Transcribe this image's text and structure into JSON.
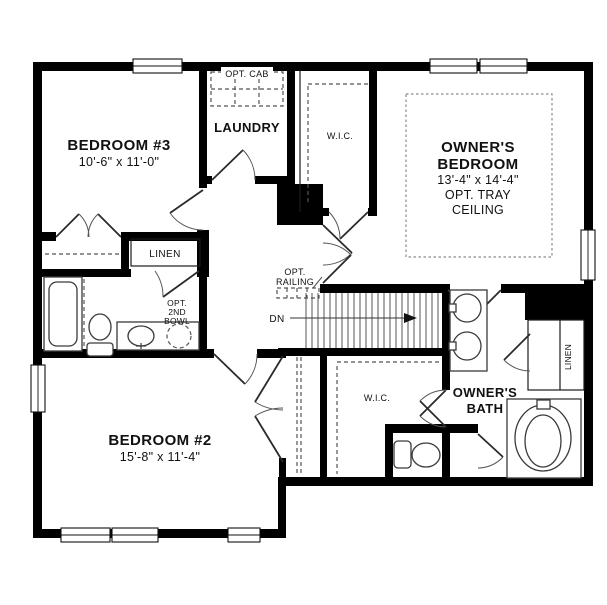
{
  "figure_type": "second-floor residential floor plan",
  "rooms": {
    "bedroom3": {
      "name": "BEDROOM #3",
      "dims": "10'-6\" x 11'-0\""
    },
    "bedroom2": {
      "name": "BEDROOM #2",
      "dims": "15'-8\" x 11'-4\""
    },
    "owners_bedroom": {
      "name_line1": "OWNER'S",
      "name_line2": "BEDROOM",
      "dims": "13'-4\" x 14'-4\"",
      "option_line1": "OPT. TRAY",
      "option_line2": "CEILING"
    },
    "laundry": {
      "name": "LAUNDRY"
    },
    "walk_in_closet_top": {
      "name": "W.I.C."
    },
    "walk_in_closet_bottom": {
      "name": "W.I.C."
    },
    "owners_bath": {
      "name_line1": "OWNER'S",
      "name_line2": "BATH"
    },
    "linen_hall": {
      "name": "LINEN"
    },
    "linen_owners": {
      "name": "LINEN"
    }
  },
  "annotations": {
    "optional_cabinets": "OPT. CAB",
    "optional_railing_line1": "OPT.",
    "optional_railing_line2": "RAILING",
    "stair_direction": "DN",
    "optional_second_bowl_line1": "OPT.",
    "optional_second_bowl_line2": "2ND",
    "optional_second_bowl_line3": "BOWL"
  },
  "colors": {
    "wall": "#000000",
    "background": "#ffffff",
    "fixture_line": "#3a3a3a",
    "dash_line": "#555555"
  }
}
